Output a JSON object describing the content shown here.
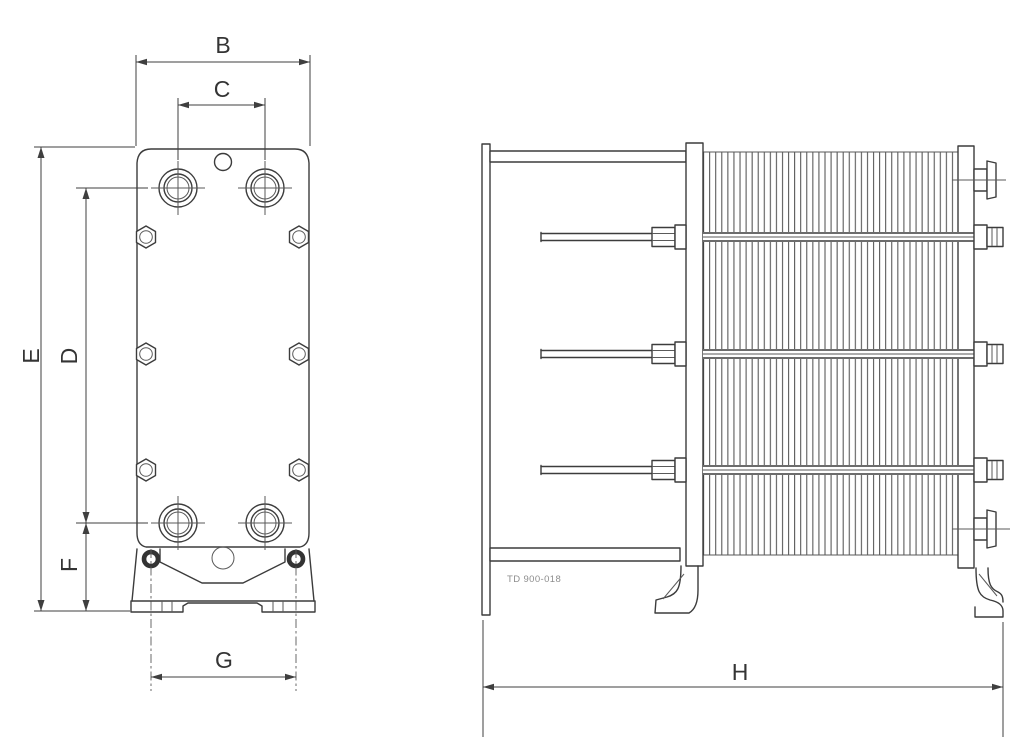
{
  "diagram": {
    "type": "engineering-drawing",
    "views": [
      "front-view",
      "side-view"
    ],
    "drawing_code": "TD 900-018",
    "dimension_labels": {
      "B": "B",
      "C": "C",
      "D": "D",
      "E": "E",
      "F": "F",
      "G": "G",
      "H": "H"
    },
    "colors": {
      "background": "#ffffff",
      "object_line": "#3c3c3c",
      "thin_line": "#5a5a5a",
      "dimension_line": "#3f3f3f",
      "label_text": "#343434",
      "drawing_code_text": "#8d8d8d"
    },
    "side_view": {
      "plate_pack_line_count": 43
    }
  }
}
